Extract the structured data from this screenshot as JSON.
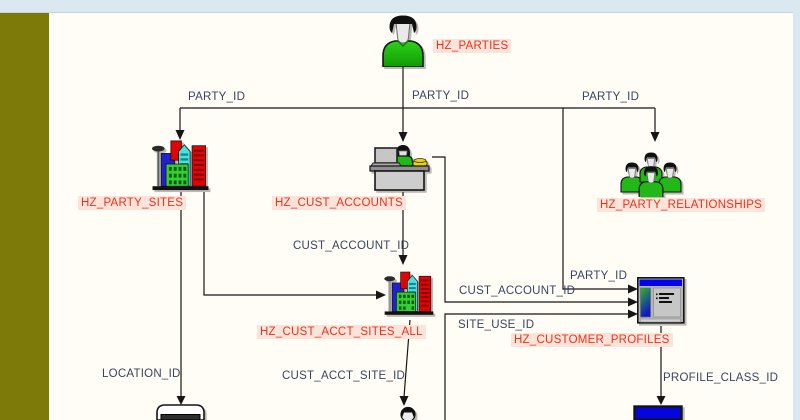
{
  "diagram": {
    "labels": {
      "hz_parties": "HZ_PARTIES",
      "hz_party_sites": "HZ_PARTY_SITES",
      "hz_cust_accounts": "HZ_CUST_ACCOUNTS",
      "hz_party_relationships": "HZ_PARTY_RELATIONSHIPS",
      "hz_cust_acct_sites_all": "HZ_CUST_ACCT_SITES_ALL",
      "hz_customer_profiles": "HZ_CUSTOMER_PROFILES",
      "party_id_left": "PARTY_ID",
      "party_id_mid": "PARTY_ID",
      "party_id_right": "PARTY_ID",
      "party_id_profiles": "PARTY_ID",
      "cust_account_id_mid": "CUST_ACCOUNT_ID",
      "cust_account_id_right": "CUST_ACCOUNT_ID",
      "site_use_id": "SITE_USE_ID",
      "cust_acct_site_id": "CUST_ACCT_SITE_ID",
      "location_id": "LOCATION_ID",
      "profile_class_id": "PROFILE_CLASS_ID"
    },
    "icons": [
      {
        "entity": "HZ_PARTIES",
        "icon": "person-icon"
      },
      {
        "entity": "HZ_PARTY_SITES",
        "icon": "buildings-icon"
      },
      {
        "entity": "HZ_CUST_ACCOUNTS",
        "icon": "desk-person-icon"
      },
      {
        "entity": "HZ_PARTY_RELATIONSHIPS",
        "icon": "people-group-icon"
      },
      {
        "entity": "HZ_CUST_ACCT_SITES_ALL",
        "icon": "buildings-icon"
      },
      {
        "entity": "HZ_CUSTOMER_PROFILES",
        "icon": "profile-window-icon"
      },
      {
        "entity": "",
        "icon": "location-box-icon"
      },
      {
        "entity": "",
        "icon": "person-head-icon"
      },
      {
        "entity": "",
        "icon": "blue-bar-icon"
      }
    ]
  },
  "colors": {
    "sidebar_olive": "#7e7a09",
    "strip_blue": "#d9e8f1",
    "canvas": "#fffdf6",
    "entity_label_red": "#e8331c",
    "entity_label_bg": "#fce4da",
    "fk_label_blue": "#35465f",
    "line_black": "#161616",
    "shirt_green": "#22b818",
    "window_title_blue": "#0202ee",
    "profile_class_blue": "#0505dd"
  }
}
